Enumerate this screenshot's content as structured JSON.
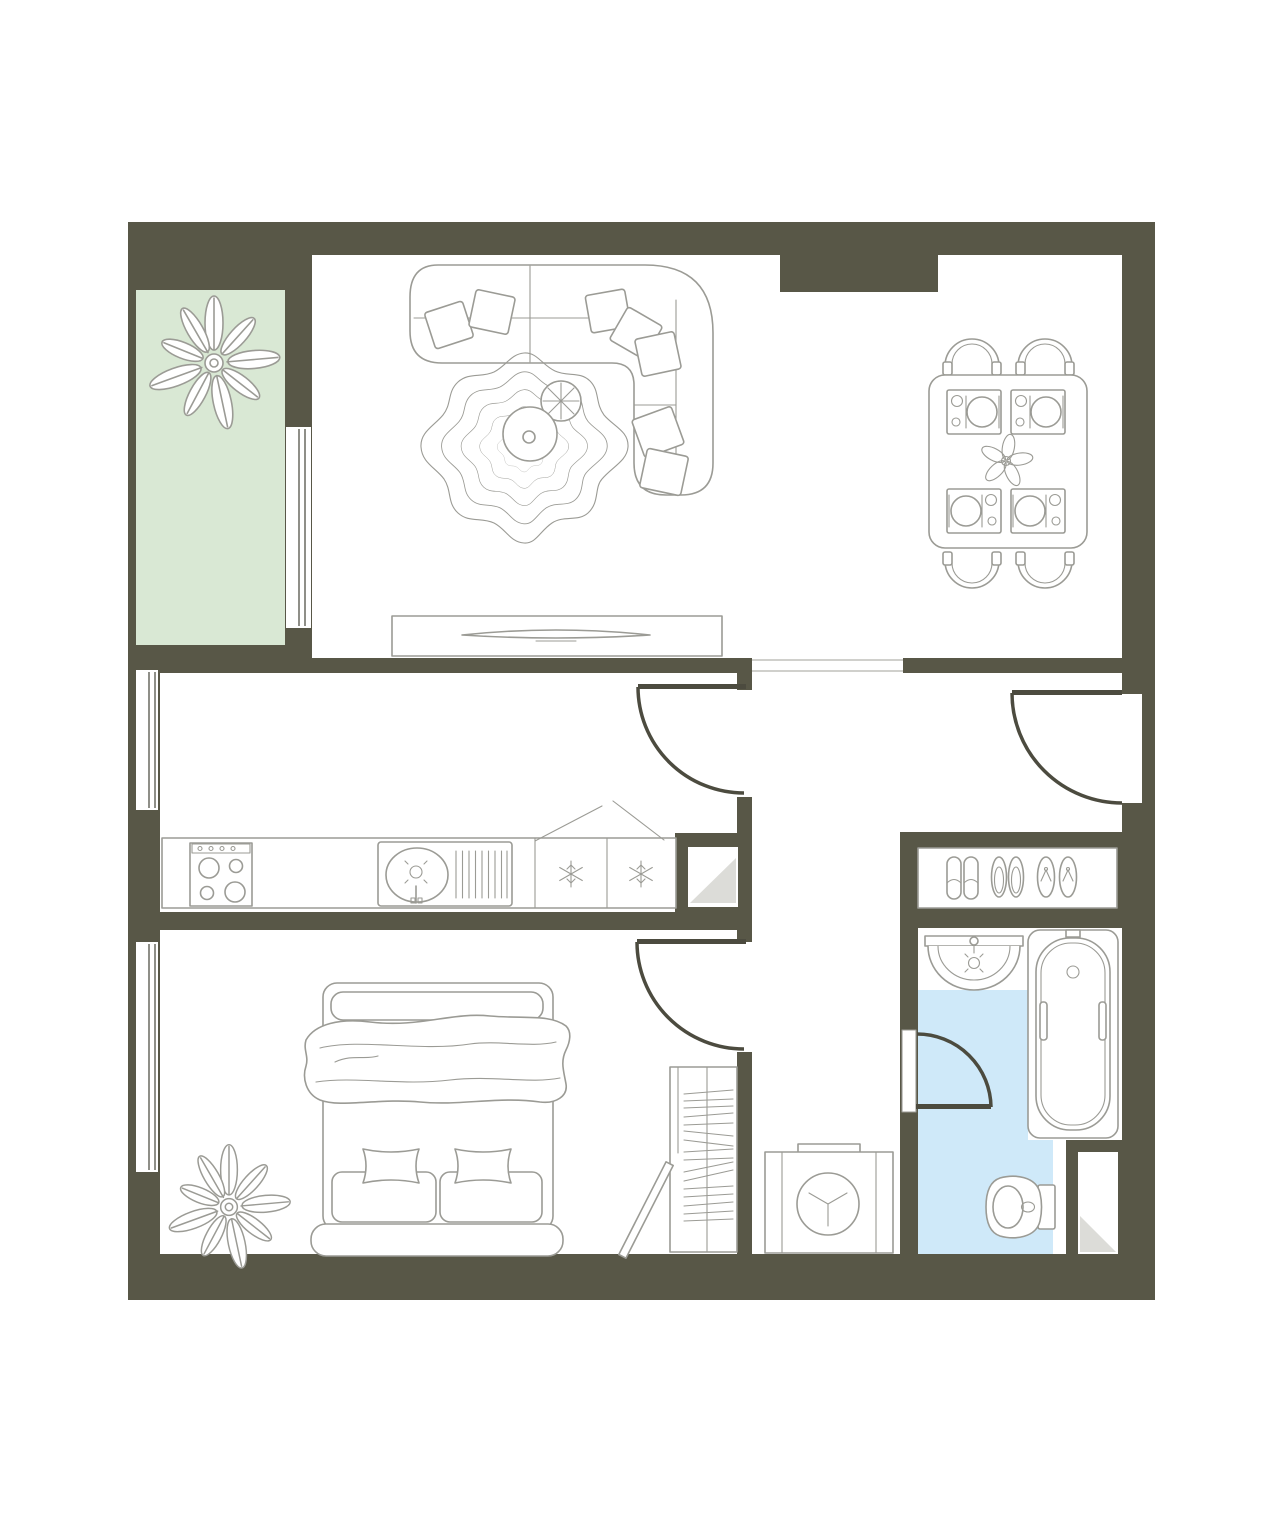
{
  "meta": {
    "title": "one-bedroom-apartment-floor-plan",
    "plan_type": "top-down architectural floor plan",
    "visible_text": "none"
  },
  "colors": {
    "page_bg": "#ffffff",
    "wall": "#585747",
    "floor": "#ffffff",
    "balcony_floor": "#d9e8d4",
    "bathroom_floor": "#cfe9f9",
    "line": "#9b9b95",
    "door": "#4c4b3f",
    "glaze": "#8f8f88",
    "hairline": "#b3b3ad",
    "shaft_shade": "#dcdcd8"
  },
  "rooms": [
    {
      "name": "balcony",
      "floor": "green",
      "furniture": [
        "large-plant"
      ]
    },
    {
      "name": "living-room",
      "floor": "white",
      "furniture": [
        "corner-sofa",
        "throw-pillows",
        "wavy-rug",
        "round-coffee-table",
        "potted-plant",
        "tv-console",
        "tv"
      ]
    },
    {
      "name": "dining-area",
      "floor": "white",
      "furniture": [
        "dining-table",
        "four-chairs",
        "four-place-settings",
        "flower-centerpiece"
      ]
    },
    {
      "name": "kitchen",
      "floor": "white",
      "furniture": [
        "counter",
        "stove-4-burners",
        "sink-with-drainer",
        "fridge-freezer-two-compartments"
      ]
    },
    {
      "name": "bedroom",
      "floor": "white",
      "furniture": [
        "double-bed",
        "blanket",
        "four-pillows",
        "wardrobe-with-clothes",
        "open-wardrobe-door",
        "large-plant"
      ]
    },
    {
      "name": "hallway",
      "floor": "white",
      "furniture": [
        "shoe-rack",
        "washing-machine"
      ]
    },
    {
      "name": "bathroom",
      "floor": "blue",
      "furniture": [
        "wash-basin",
        "bathtub",
        "toilet",
        "ventilation-shaft"
      ]
    }
  ],
  "openings": {
    "entrance_door": "right wall, swings into hallway",
    "kitchen_door": "swings into kitchen",
    "bedroom_door": "swings into bedroom",
    "bathroom_door": "swings into bathroom",
    "living_hall_passage": "open passage, no door",
    "windows": [
      "kitchen-left-wall",
      "bedroom-left-wall",
      "balcony-to-living-room"
    ]
  }
}
